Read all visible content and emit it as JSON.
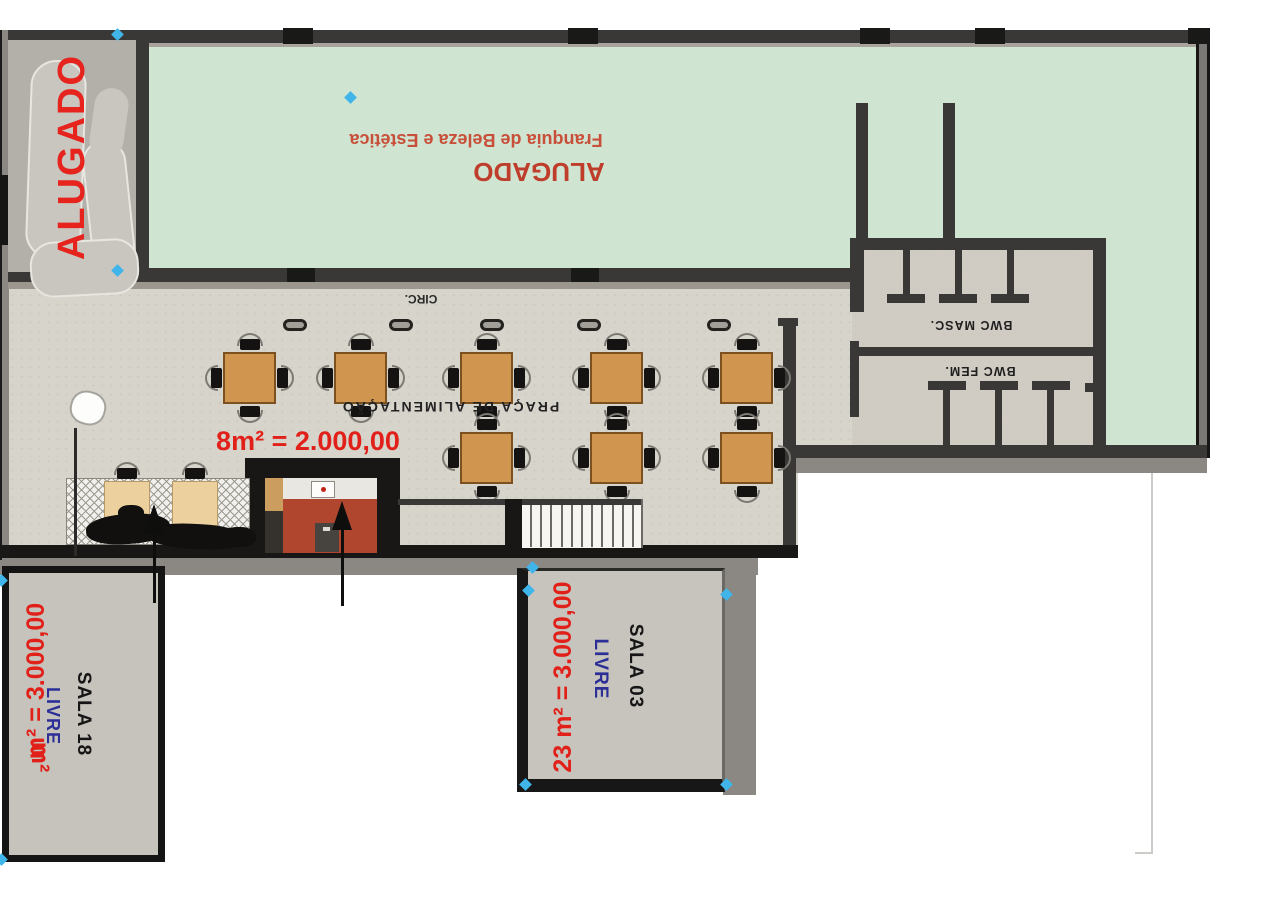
{
  "title": "Planta - pavimento comercial",
  "colors": {
    "green_room": "#cfe4d1",
    "floor_gray": "#d7d4cc",
    "wall_dark": "#3a3836",
    "wall_gray": "#8b8883",
    "room_fill": "#c6c3bc",
    "wood_table": "#d0954e",
    "brick_kiosk": "#b0462e",
    "price_red": "#e02019",
    "stamp_red": "#e6231d",
    "livre_blue": "#2b2f96",
    "marker_cyan": "#3fb5ea"
  },
  "stamp": {
    "label": "ALUGADO"
  },
  "green_room": {
    "business": "Franquia de Beleza e Estética",
    "status": "ALUGADO"
  },
  "corridor": {
    "label": "CIRC."
  },
  "food_court": {
    "label": "PRAÇA DE ALIMENTAÇÃO",
    "kiosk_price": "8m² = 2.000,00"
  },
  "bathrooms": {
    "male": "BWC MASC.",
    "female": "BWC FEM."
  },
  "sala18": {
    "name": "SALA 18",
    "price": "m² = 3.000,00",
    "artifact": "m²",
    "status": "LIVRE"
  },
  "sala03": {
    "name": "SALA 03",
    "price": "23 m² = 3.000,00",
    "status": "LIVRE"
  }
}
